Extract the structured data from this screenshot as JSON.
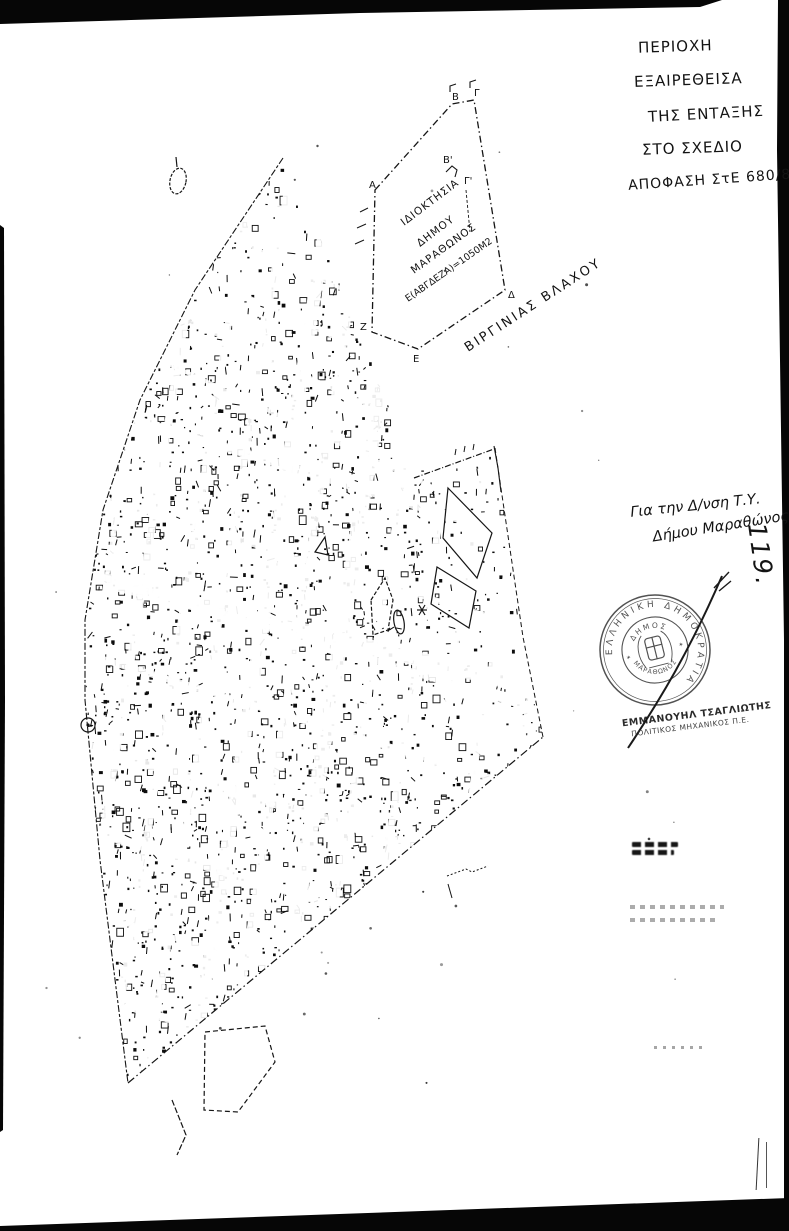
{
  "page": {
    "background": "#ffffff",
    "ink": "#141414",
    "description": "Scanned cadastral plan sheet, Municipality of Marathon"
  },
  "exclusion_note": {
    "lines": [
      "ΠΕΡΙΟΧΗ",
      "ΕΞΑΙΡΕΘΕΙΣΑ",
      "ΤΗΣ ΕΝΤΑΞΗΣ",
      "ΣΤΟ ΣΧΕΔΙΟ",
      "ΑΠΟΦΑΣΗ ΣτΕ 680/87"
    ]
  },
  "parcel_diagram": {
    "owner_line1": "ΙΔΙΟΚΤΗΣΙΑ",
    "owner_line2": "ΔΗΜΟΥ",
    "owner_line3": "ΜΑΡΑΘΩΝΟΣ",
    "area_label": "Ε(ΑΒΓΔΕΖΑ)=1050Μ2",
    "street_label": "ΒΙΡΓΙΝΙΑΣ ΒΛΑΧΟΥ",
    "corner_labels": {
      "alpha": "Α",
      "beta": "Β",
      "gamma": "Γ",
      "beta_prime": "Β'",
      "gamma_prime": "Γ'",
      "delta": "Δ",
      "epsilon": "Ε",
      "zeta": "Ζ"
    }
  },
  "approval_note": {
    "line1": "Για την Δ/νση Τ.Υ.",
    "line2": "Δήμου Μαραθώνος"
  },
  "sheet_number": "119.",
  "stamp": {
    "outer_text": "ΕΛΛΗΝΙΚΗ ΔΗΜΟΚΡΑΤΙΑ",
    "inner_top": "ΔΗΜΟΣ",
    "inner_bottom": "ΜΑΡΑΘΩΝΟΣ",
    "star_left": "✶",
    "star_right": "✶"
  },
  "engineer": {
    "name": "ΕΜΜΑΝΟΥΗΛ ΤΣΑΓΛΙΩΤΗΣ",
    "title": "ΠΟΛΙΤΙΚΟΣ ΜΗΧΑΝΙΚΟΣ Π.Ε."
  }
}
